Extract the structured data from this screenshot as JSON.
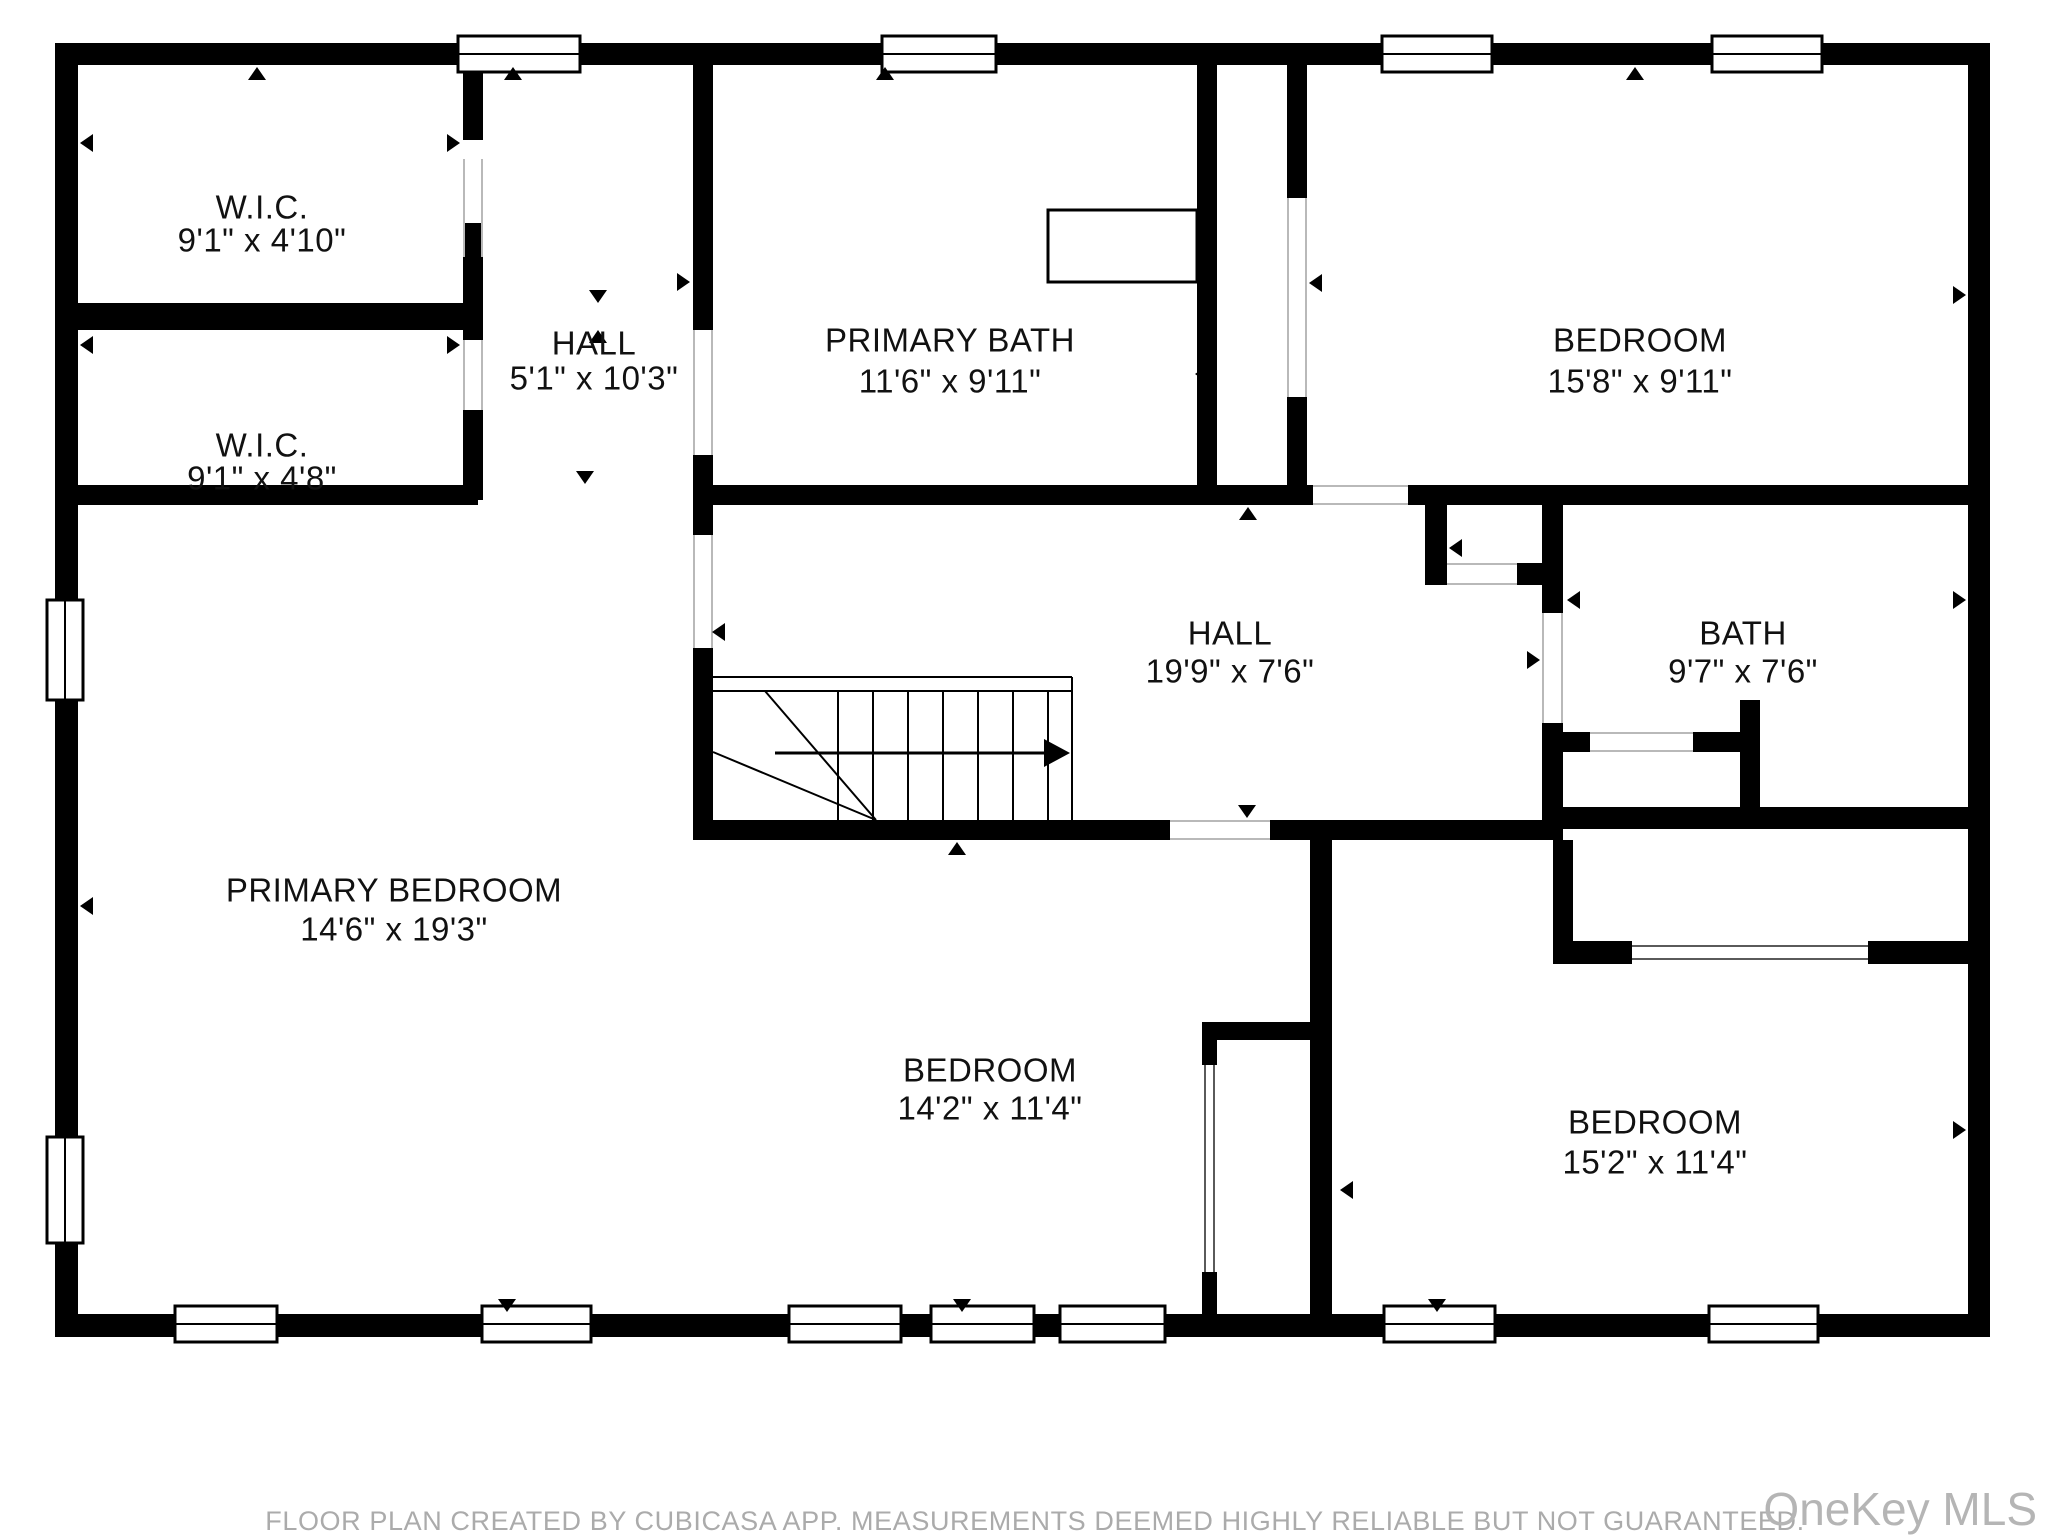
{
  "floorplan": {
    "rooms": [
      {
        "name": "W.I.C.",
        "dims": "9'1\" x 4'10\""
      },
      {
        "name": "W.I.C.",
        "dims": "9'1\" x 4'8\""
      },
      {
        "name": "HALL",
        "dims": "5'1\" x 10'3\""
      },
      {
        "name": "PRIMARY BATH",
        "dims": "11'6\" x 9'11\""
      },
      {
        "name": "BEDROOM",
        "dims": "15'8\" x 9'11\""
      },
      {
        "name": "HALL",
        "dims": "19'9\" x 7'6\""
      },
      {
        "name": "BATH",
        "dims": "9'7\" x 7'6\""
      },
      {
        "name": "PRIMARY BEDROOM",
        "dims": "14'6\" x 19'3\""
      },
      {
        "name": "BEDROOM",
        "dims": "14'2\" x 11'4\""
      },
      {
        "name": "BEDROOM",
        "dims": "15'2\" x 11'4\""
      }
    ],
    "footer": "FLOOR PLAN CREATED BY CUBICASA APP. MEASUREMENTS DEEMED HIGHLY RELIABLE BUT NOT GUARANTEED.",
    "watermark": "OneKey MLS",
    "colors": {
      "wall": "#000000",
      "background": "#ffffff",
      "room_text": "#111111",
      "footer_text": "#ababab",
      "watermark_text": "#b5b5b5"
    }
  }
}
